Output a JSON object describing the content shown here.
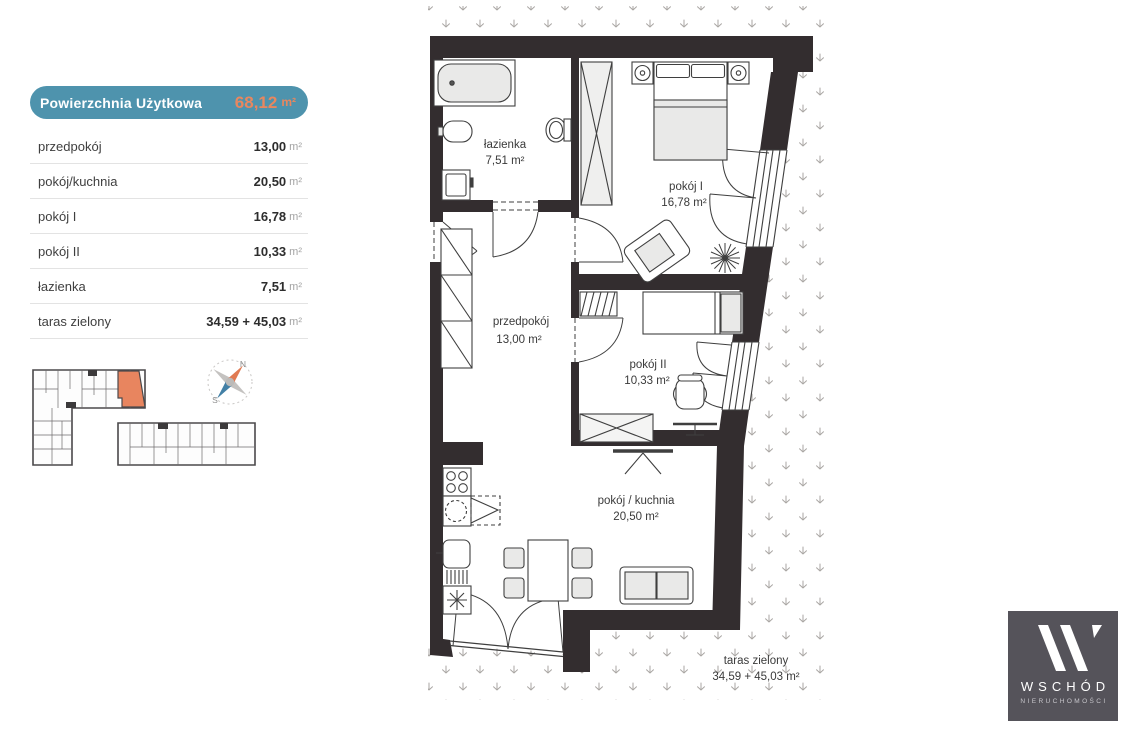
{
  "summary": {
    "header": {
      "label": "Powierzchnia Użytkowa",
      "value": "68,12",
      "unit": "m²"
    },
    "rows": [
      {
        "label": "przedpokój",
        "value": "13,00",
        "unit": "m²"
      },
      {
        "label": "pokój/kuchnia",
        "value": "20,50",
        "unit": "m²"
      },
      {
        "label": "pokój I",
        "value": "16,78",
        "unit": "m²"
      },
      {
        "label": "pokój II",
        "value": "10,33",
        "unit": "m²"
      },
      {
        "label": "łazienka",
        "value": "7,51",
        "unit": "m²"
      },
      {
        "label": "taras zielony",
        "value": "34,59 + 45,03",
        "unit": "m²"
      }
    ]
  },
  "plan": {
    "rooms": [
      {
        "name": "łazienka",
        "area": "7,51 m²"
      },
      {
        "name": "pokój I",
        "area": "16,78 m²"
      },
      {
        "name": "przedpokój",
        "area": "13,00 m²"
      },
      {
        "name": "pokój II",
        "area": "10,33 m²"
      },
      {
        "name": "pokój / kuchnia",
        "area": "20,50 m²"
      },
      {
        "name": "taras zielony",
        "area": "34,59 + 45,03 m²"
      }
    ]
  },
  "compass": {
    "north": "N",
    "south": "S"
  },
  "logo": {
    "name": "WSCHÓD",
    "subtitle": "NIERUCHOMOŚCI"
  },
  "colors": {
    "accent_teal": "#4E93AD",
    "accent_orange": "#E8875F",
    "wall": "#332D2F",
    "grass": "#a9a6a3",
    "logo_bg": "#55535A"
  }
}
